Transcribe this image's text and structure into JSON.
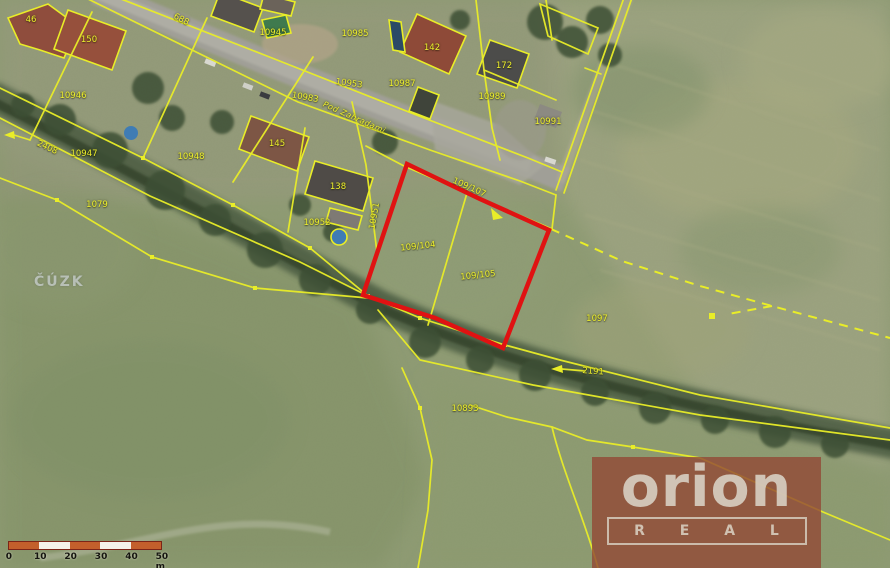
{
  "map": {
    "watermark": "ČÚZK",
    "colors": {
      "parcel_line": "#e9ed28",
      "highlight_outline": "#e01212",
      "label_text": "#edef2d",
      "scale_orange": "#c35f2c",
      "logo_bg": "rgba(146,72,54,0.8)",
      "logo_text": "rgba(218,211,198,0.88)"
    },
    "highlighted_parcels": [
      "109/104",
      "109/105"
    ],
    "labels": [
      {
        "t": "46",
        "x": 31,
        "y": 20,
        "r": 0
      },
      {
        "t": "150",
        "x": 89,
        "y": 40,
        "r": 0
      },
      {
        "t": "688",
        "x": 181,
        "y": 20,
        "r": 27
      },
      {
        "t": "10945",
        "x": 273,
        "y": 33,
        "r": 0
      },
      {
        "t": "10985",
        "x": 355,
        "y": 34,
        "r": 0
      },
      {
        "t": "142",
        "x": 432,
        "y": 48,
        "r": 0
      },
      {
        "t": "172",
        "x": 504,
        "y": 66,
        "r": 0
      },
      {
        "t": "10953",
        "x": 349,
        "y": 84,
        "r": 8
      },
      {
        "t": "10987",
        "x": 402,
        "y": 84,
        "r": 0
      },
      {
        "t": "10983",
        "x": 305,
        "y": 98,
        "r": 10
      },
      {
        "t": "10989",
        "x": 492,
        "y": 97,
        "r": 0
      },
      {
        "t": "10991",
        "x": 548,
        "y": 122,
        "r": 0
      },
      {
        "t": "10946",
        "x": 73,
        "y": 96,
        "r": 0
      },
      {
        "t": "Pod Zahradami",
        "x": 354,
        "y": 118,
        "r": 24,
        "cls": "street"
      },
      {
        "t": "2408",
        "x": 47,
        "y": 148,
        "r": 25
      },
      {
        "t": "10947",
        "x": 84,
        "y": 154,
        "r": 0
      },
      {
        "t": "10948",
        "x": 191,
        "y": 157,
        "r": 0
      },
      {
        "t": "145",
        "x": 277,
        "y": 144,
        "r": 0
      },
      {
        "t": "138",
        "x": 338,
        "y": 187,
        "r": 0
      },
      {
        "t": "1079",
        "x": 97,
        "y": 205,
        "r": 0
      },
      {
        "t": "10951",
        "x": 375,
        "y": 216,
        "r": -80
      },
      {
        "t": "10952",
        "x": 317,
        "y": 223,
        "r": 0
      },
      {
        "t": "109/107",
        "x": 469,
        "y": 188,
        "r": 24
      },
      {
        "t": "109/104",
        "x": 418,
        "y": 247,
        "r": -6
      },
      {
        "t": "109/105",
        "x": 478,
        "y": 276,
        "r": -6
      },
      {
        "t": "1097",
        "x": 597,
        "y": 319,
        "r": 0
      },
      {
        "t": "2191",
        "x": 593,
        "y": 372,
        "r": 4
      },
      {
        "t": "10893",
        "x": 465,
        "y": 409,
        "r": 0
      }
    ],
    "scale_bar": {
      "ticks": [
        "0",
        "10",
        "20",
        "30",
        "40",
        "50 m"
      ],
      "segment_count": 5
    },
    "logo": {
      "brand": "orion",
      "sub": "R E A L"
    }
  }
}
